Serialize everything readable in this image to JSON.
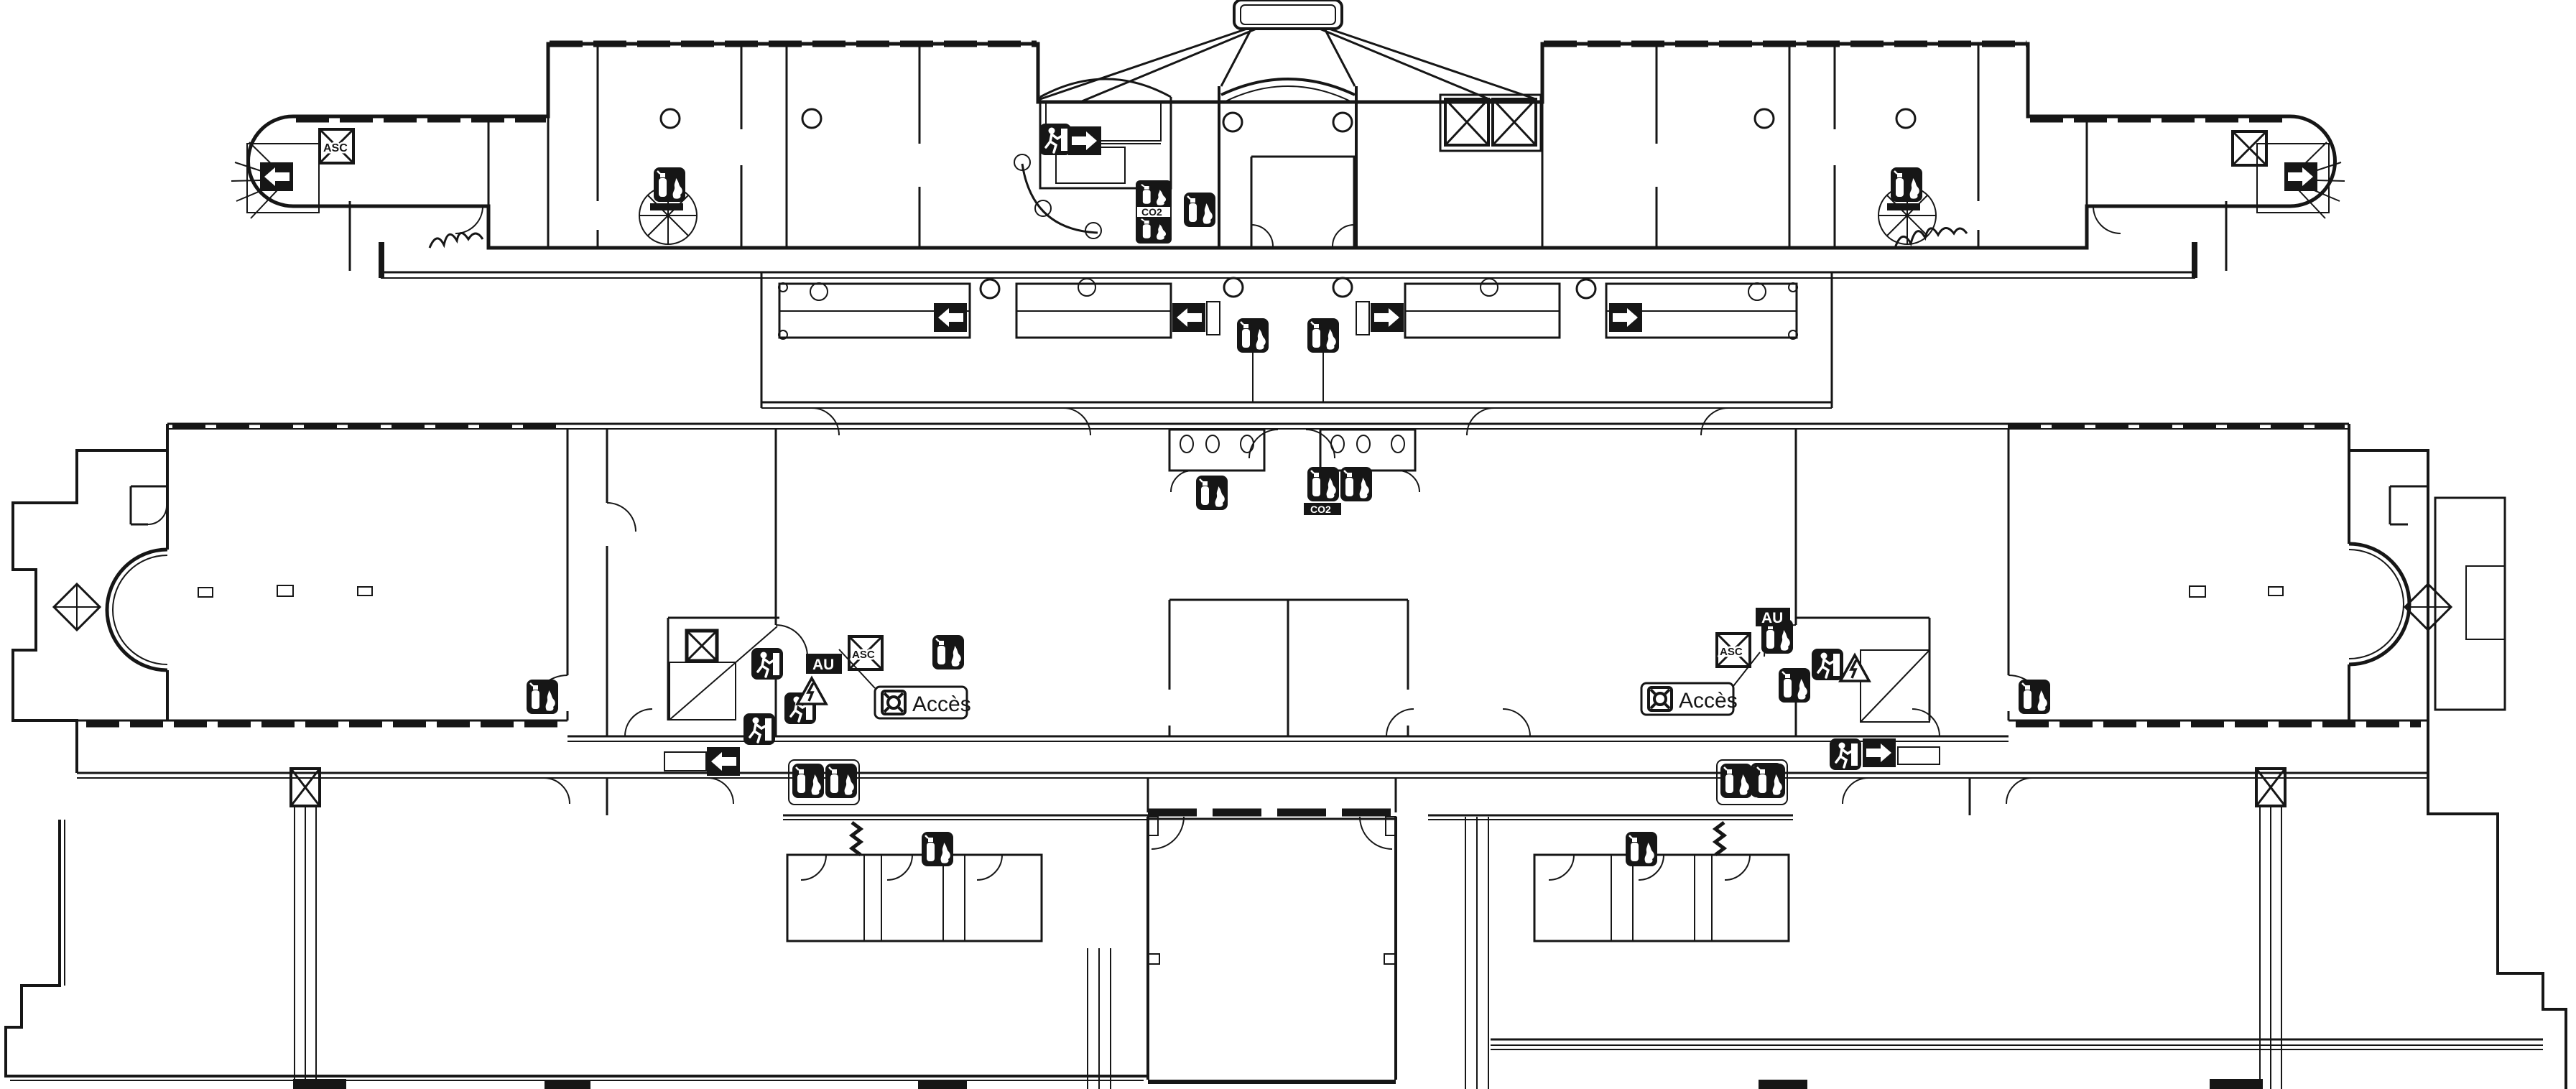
{
  "plan": {
    "kind": "building evacuation floor plan (line drawing)",
    "background_color": "#ffffff",
    "ink_color": "#161616",
    "labels": {
      "access_left": "Accès",
      "access_right": "Accès",
      "elevator_top_left": "ASC",
      "elevator_mid_left": "ASC",
      "elevator_mid_right": "ASC",
      "call_point_left": "AU",
      "call_point_right": "AU",
      "co2_stair": "CO2",
      "co2_center": "CO2"
    },
    "icons": [
      "fire-extinguisher-icon",
      "exit-running-person-icon",
      "exit-direction-arrow-icon",
      "elevator-cross-box-icon",
      "access-marker-icon",
      "electrical-danger-triangle-icon",
      "stairs-hatching",
      "spiral-staircase-icon",
      "expansion-joint-zigzag-icon",
      "column-circle-icon",
      "column-diamond-icon",
      "braced-column-icon"
    ]
  }
}
